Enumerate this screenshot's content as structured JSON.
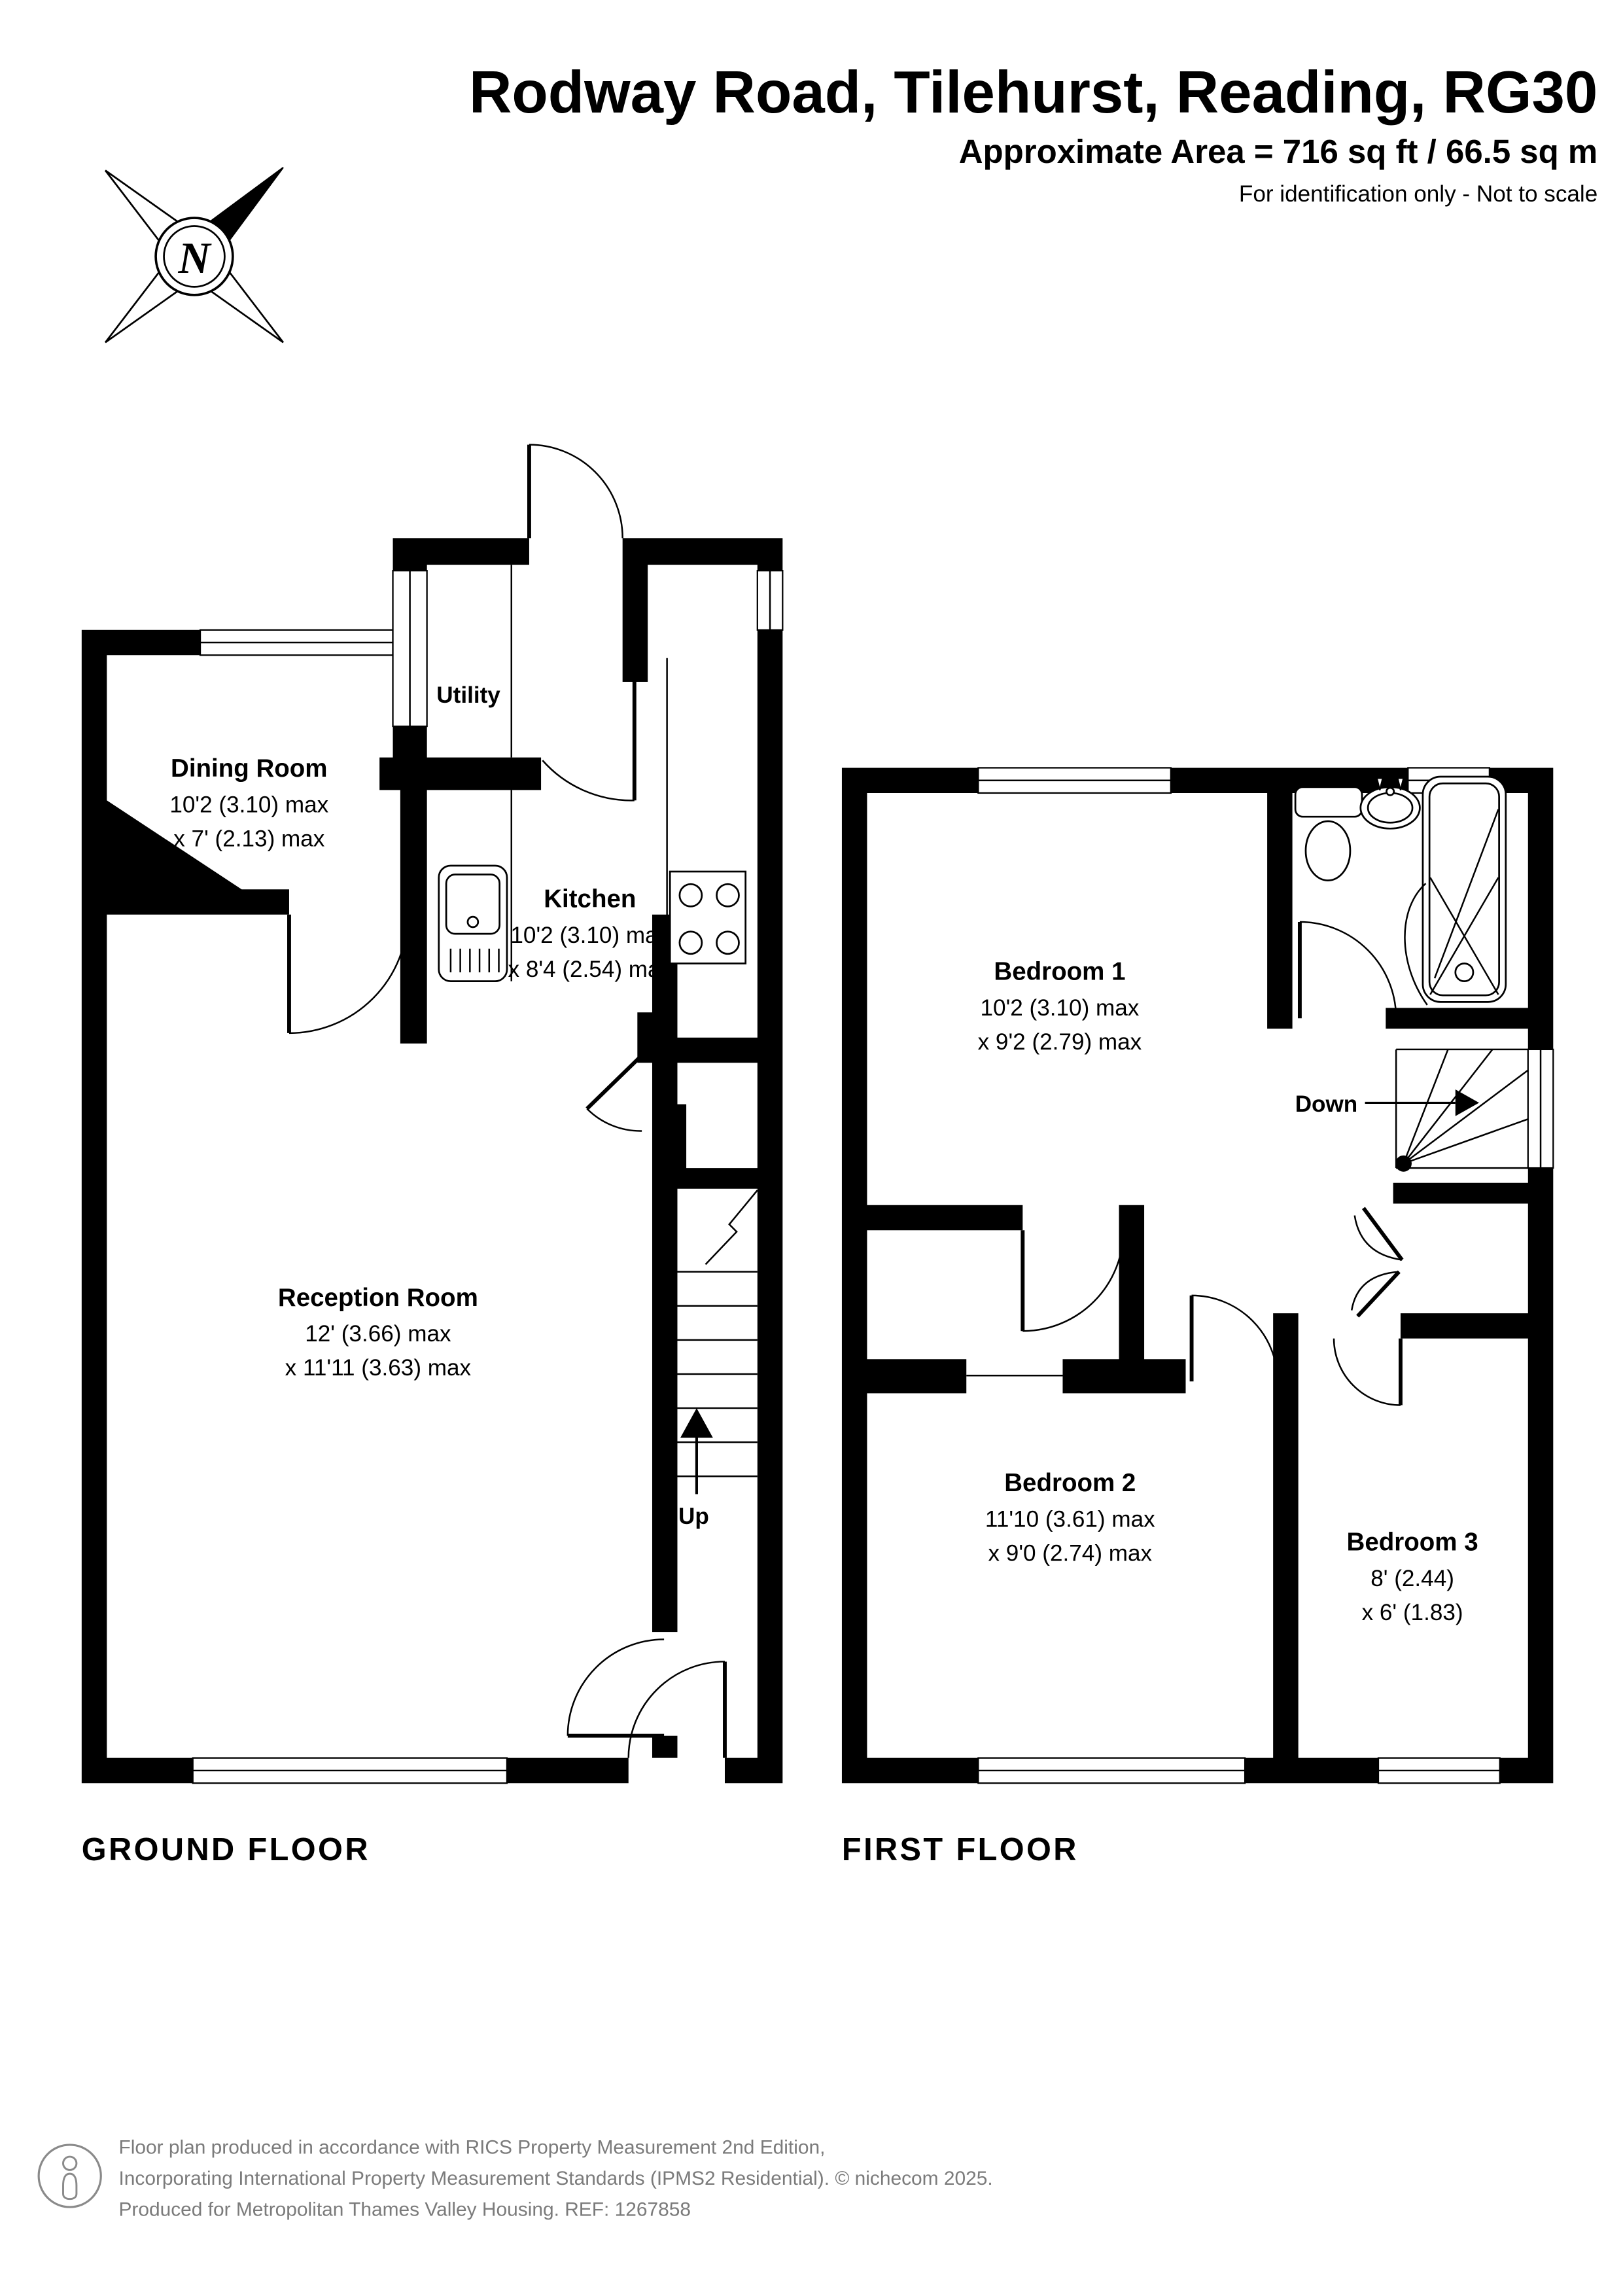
{
  "header": {
    "title": "Rodway Road, Tilehurst, Reading, RG30",
    "area": "Approximate Area = 716 sq ft / 66.5 sq m",
    "note": "For identification only - Not to scale"
  },
  "compass": {
    "label": "N"
  },
  "ground": {
    "caption": "GROUND FLOOR",
    "stairs_label": "Up",
    "rooms": {
      "utility": {
        "name": "Utility"
      },
      "dining": {
        "name": "Dining Room",
        "dim1": "10'2 (3.10) max",
        "dim2": "x 7' (2.13) max"
      },
      "kitchen": {
        "name": "Kitchen",
        "dim1": "10'2 (3.10) max",
        "dim2": "x 8'4 (2.54) max"
      },
      "reception": {
        "name": "Reception Room",
        "dim1": "12' (3.66) max",
        "dim2": "x 11'11 (3.63) max"
      }
    }
  },
  "first": {
    "caption": "FIRST FLOOR",
    "stairs_label": "Down",
    "rooms": {
      "bed1": {
        "name": "Bedroom 1",
        "dim1": "10'2 (3.10) max",
        "dim2": "x 9'2 (2.79) max"
      },
      "bed2": {
        "name": "Bedroom 2",
        "dim1": "11'10 (3.61) max",
        "dim2": "x 9'0 (2.74) max"
      },
      "bed3": {
        "name": "Bedroom 3",
        "dim1": "8' (2.44)",
        "dim2": "x 6' (1.83)"
      }
    }
  },
  "footer": {
    "line1": "Floor plan produced in accordance with RICS Property Measurement 2nd Edition,",
    "line2": "Incorporating International Property Measurement Standards (IPMS2 Residential).  © nichecom 2025.",
    "line3": "Produced for Metropolitan Thames Valley Housing.   REF:  1267858"
  }
}
